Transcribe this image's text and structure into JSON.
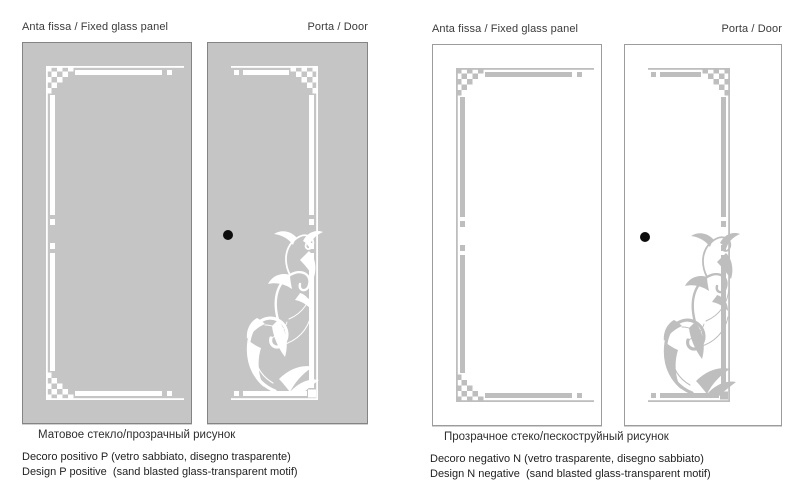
{
  "sets": [
    {
      "fixed_panel_label": "Anta fissa / Fixed glass panel",
      "door_label": "Porta / Door",
      "glass_note_ru": "Матовое стекло/прозрачный рисунок",
      "decor_line_it": "Decoro positivo P (vetro sabbiato, disegno trasparente)",
      "decor_line_en": "Design P positive  (sand blasted glass-transparent motif)",
      "colors": {
        "glass": "#c4c5c4",
        "motif": "#ffffff",
        "border": "#848484",
        "handle": "#0d0d0d"
      }
    },
    {
      "fixed_panel_label": "Anta fissa / Fixed glass panel",
      "door_label": "Porta / Door",
      "glass_note_ru": "Прозрачное стеко/пескоструйный рисунок",
      "decor_line_it": "Decoro negativo N (vetro trasparente, disegno sabbiato)",
      "decor_line_en": "Design N negative  (sand blasted glass-transparent motif)",
      "colors": {
        "glass": "#ffffff",
        "motif": "#bdbebd",
        "border": "#9c9c9c",
        "handle": "#0d0d0d"
      }
    }
  ]
}
